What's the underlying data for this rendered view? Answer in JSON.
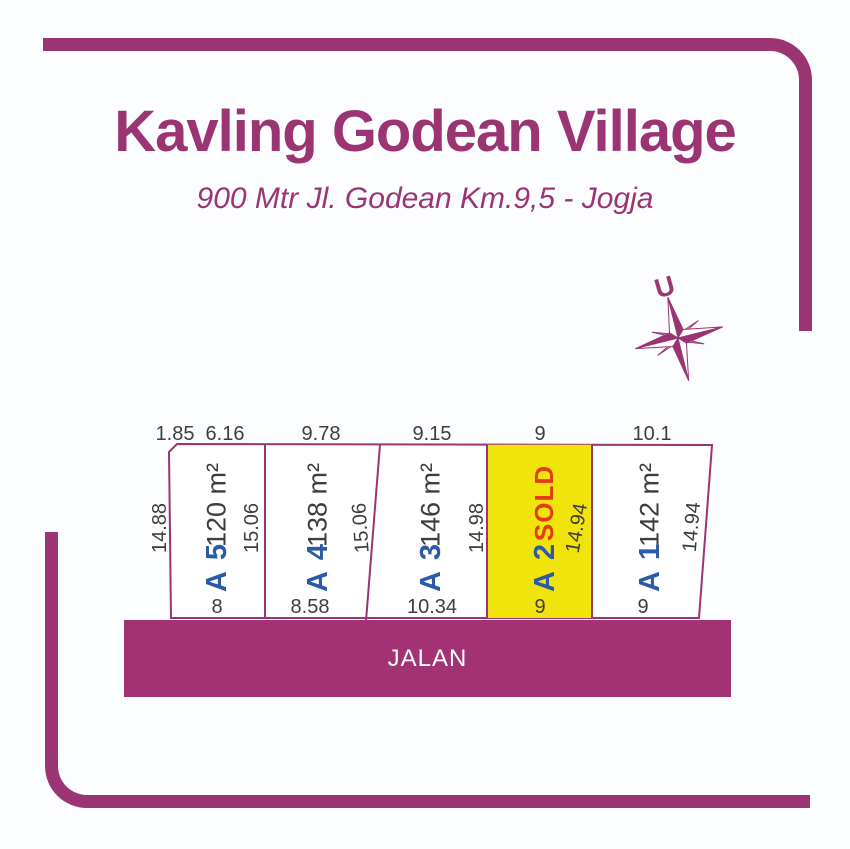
{
  "header": {
    "title": "Kavling Godean Village",
    "subtitle": "900 Mtr Jl. Godean Km.9,5 - Jogja"
  },
  "compass": {
    "north_label": "U"
  },
  "road": {
    "label": "JALAN"
  },
  "plots": [
    {
      "id": "A 5",
      "area": "120 m²",
      "top_dim": "6.16",
      "bottom_dim": "8"
    },
    {
      "id": "A 4",
      "area": "138 m²",
      "top_dim": "9.78",
      "bottom_dim": "8.58"
    },
    {
      "id": "A 3",
      "area": "146 m²",
      "top_dim": "9.15",
      "bottom_dim": "10.34"
    },
    {
      "id": "A 2",
      "status": "SOLD",
      "top_dim": "9",
      "bottom_dim": "9"
    },
    {
      "id": "A 1",
      "area": "142 m²",
      "top_dim": "10.1",
      "bottom_dim": "9"
    }
  ],
  "side_dims": {
    "top_left_bevel": "1.85",
    "left_side": "14.88",
    "a5_a4_boundary": "15.06",
    "a4_a3_boundary": "15.06",
    "a3_a2_boundary": "14.98",
    "a2_right_boundary": "14.94",
    "a1_right_boundary": "14.94"
  },
  "colors": {
    "brand_magenta": "#9B3473",
    "road_magenta": "#A33274",
    "sold_yellow": "#F1E40C",
    "plot_id_blue": "#2B5AA6",
    "sold_red": "#E23C17",
    "dim_gray": "#3D3D3D"
  }
}
